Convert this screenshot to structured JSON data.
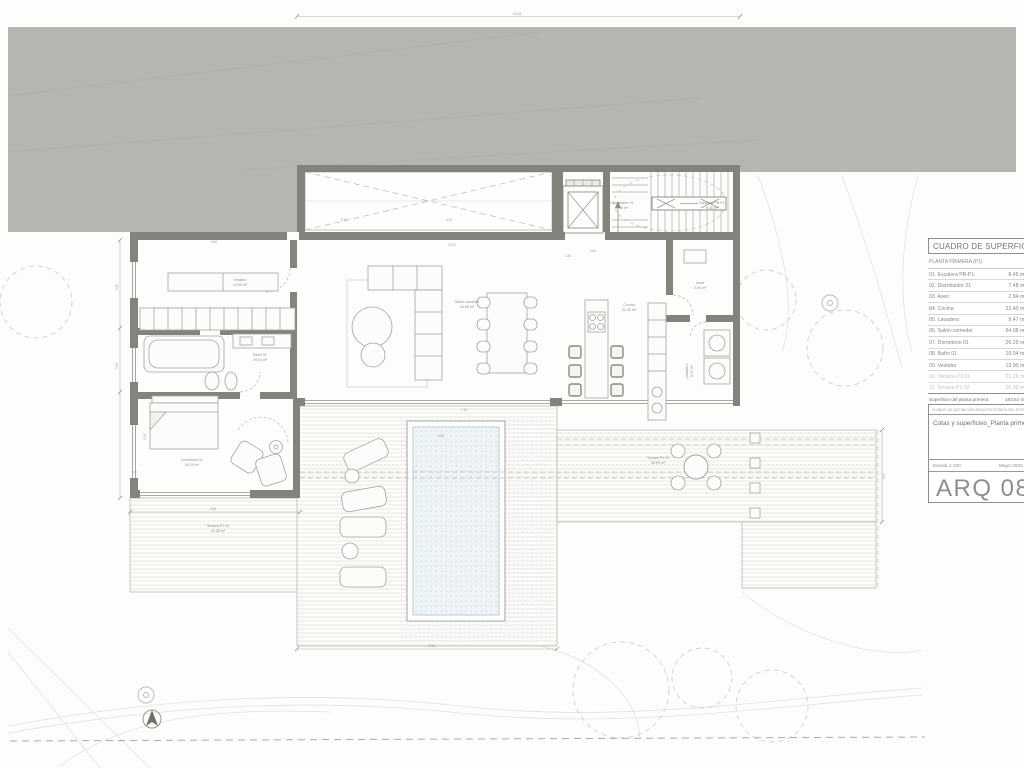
{
  "sheet": {
    "colors": {
      "site_gray": "#b5b6b2",
      "wall": "#83837d",
      "water": "#edf3f6",
      "thin_line": "#a9a9a3"
    },
    "surface_table": {
      "title": "CUADRO DE SUPERFICIES",
      "subtitle": "PLANTA PRIMERA (P1)",
      "rows": [
        {
          "label": "01. Escalera PB-P1",
          "value": "8.45 m²"
        },
        {
          "label": "02. Distribuidor 01",
          "value": "7.48 m²"
        },
        {
          "label": "03. Aseo",
          "value": "2.94 m²"
        },
        {
          "label": "04. Cocina",
          "value": "22.40 m²"
        },
        {
          "label": "05. Lavadero",
          "value": "9.47 m²"
        },
        {
          "label": "06. Salón-comedor",
          "value": "64.08 m²"
        },
        {
          "label": "07. Dormitorio 01",
          "value": "26.29 m²"
        },
        {
          "label": "08. Baño 01",
          "value": "19.04 m²"
        },
        {
          "label": "09. Vestidor",
          "value": "13.90 m²"
        },
        {
          "label": "10. Terraza P1 01",
          "value": "21.26 m²"
        },
        {
          "label": "11. Terraza P1 02",
          "value": "26.99 m²"
        }
      ],
      "totals": [
        {
          "label": "Superficie útil planta primera",
          "value": "183.62 m²"
        },
        {
          "label": "Superficie construida planta primera",
          "value": "198.12 m²"
        },
        {
          "label": "Superficie construida total (exteriores)",
          "value": "252.03 m²"
        }
      ]
    },
    "title_block": {
      "header": "PLANOS DE DEFINICIÓN ARQUITECTÓNICA DEL EDIFICIO",
      "sheet_title": "Cotas y superficies_Planta primera",
      "scale": "Escala 1:100",
      "date": "Mayo 2022",
      "code": "ARQ 08"
    },
    "plan": {
      "labels": [
        {
          "name": "Vestidor",
          "area": "13.90 m²"
        },
        {
          "name": "Baño 01",
          "area": "19.04 m²"
        },
        {
          "name": "Dormitorio 01",
          "area": "26.29 m²"
        },
        {
          "name": "Salón comedor",
          "area": "64.08 m²"
        },
        {
          "name": "Cocina",
          "area": "22.40 m²"
        },
        {
          "name": "Aseo",
          "area": "2.94 m²"
        },
        {
          "name": "Lavadero",
          "area": "9.47 m²"
        },
        {
          "name": "Distribuidor 01",
          "area": "7.48 m²"
        },
        {
          "name": "Escalera PB-P1",
          "area": "8.45 m²"
        },
        {
          "name": "Terraza P1 01",
          "area": "21.26 m²"
        },
        {
          "name": "Terraza P1 02",
          "area": "26.99 m²"
        }
      ],
      "dims": [
        {
          "t": "24.43"
        },
        {
          "t": "15.37"
        },
        {
          "t": "5.18"
        },
        {
          "t": "9.19"
        },
        {
          "t": "4.11"
        },
        {
          "t": "1.84"
        },
        {
          "t": "2.50"
        },
        {
          "t": "4.60"
        },
        {
          "t": "2.30"
        },
        {
          "t": "3.30"
        },
        {
          "t": "2.15"
        },
        {
          "t": "4.95"
        },
        {
          "t": "7.10"
        },
        {
          "t": "8.00"
        },
        {
          "t": "6.98"
        },
        {
          "t": "3.67"
        }
      ]
    }
  }
}
